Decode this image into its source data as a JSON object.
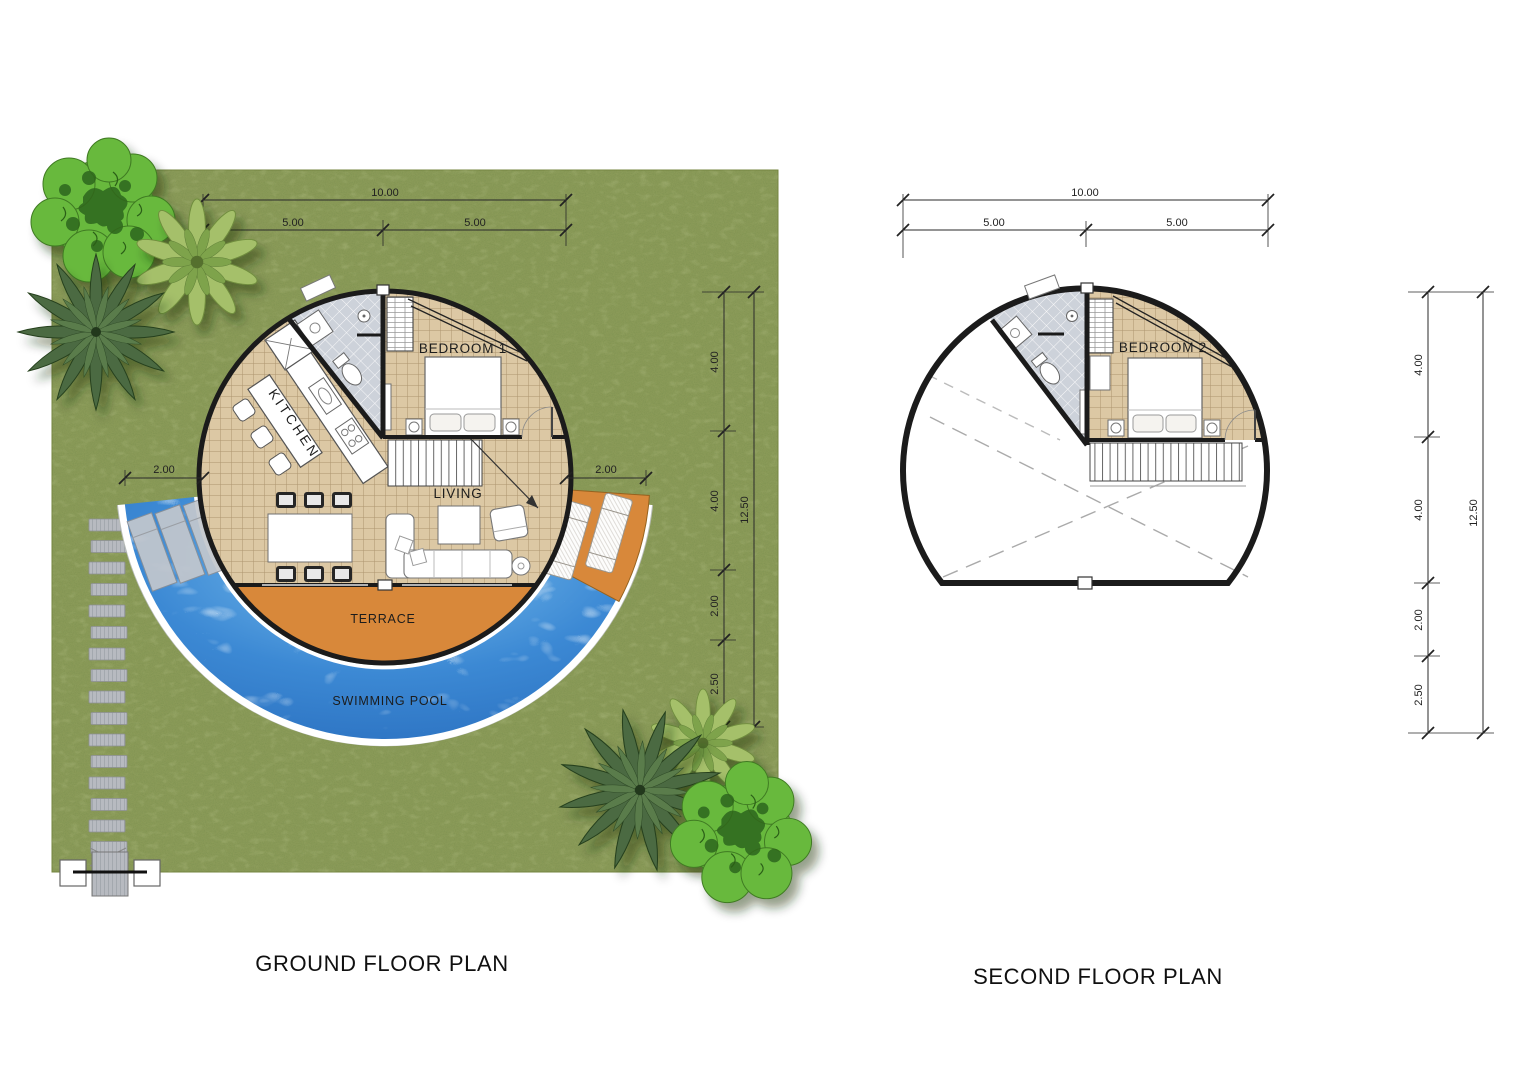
{
  "colors": {
    "grass": "#8a9a58",
    "pool": "#3c89d4",
    "pool-light": "#7cc0ee",
    "pool-deep": "#2a6fbf",
    "terrace": "#d8883a",
    "floor": "#dcc8a4",
    "tile": "#cdd2da",
    "wall": "#1b1b1b",
    "canopy": "#67b93e",
    "canopy-dark": "#2e661c",
    "palm": "#4c6a43",
    "fern": "#a5c06b",
    "stone": "#b7bac0"
  },
  "ground_floor": {
    "title": "GROUND FLOOR PLAN",
    "labels": {
      "kitchen": "KITCHEN",
      "bedroom": "BEDROOM 1",
      "living": "LIVING",
      "terrace": "TERRACE",
      "pool": "SWIMMING POOL"
    },
    "dims": {
      "total_width": "10.00",
      "left_half": "5.00",
      "right_half": "5.00",
      "left_offset": "2.00",
      "right_offset": "2.00",
      "total_height": "12.50",
      "seg1": "4.00",
      "seg2": "4.00",
      "seg3": "2.00",
      "seg4": "2.50"
    }
  },
  "second_floor": {
    "title": "SECOND FLOOR PLAN",
    "labels": {
      "bedroom": "BEDROOM 2"
    },
    "dims": {
      "total_width": "10.00",
      "left_half": "5.00",
      "right_half": "5.00",
      "total_height": "12.50",
      "seg1": "4.00",
      "seg2": "4.00",
      "seg3": "2.00",
      "seg4": "2.50"
    }
  }
}
